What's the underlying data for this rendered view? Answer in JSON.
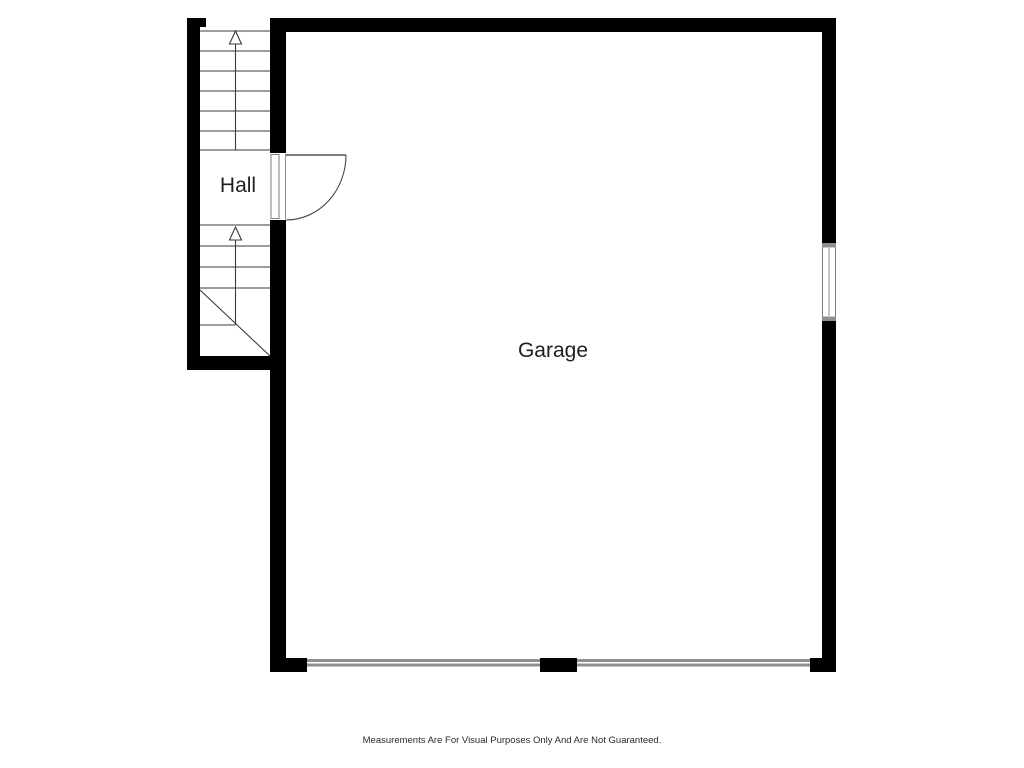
{
  "plan": {
    "labels": {
      "hall": "Hall",
      "garage": "Garage"
    },
    "stairs": {
      "upper_treads": 6,
      "lower_straight_treads": 3,
      "winder_treads": 3,
      "direction": "up",
      "arrow_count": 2
    },
    "openings": {
      "hinged_doors": 1,
      "windows": 1,
      "garage_doors": 2
    },
    "colors": {
      "wall": "#000000",
      "stair_line": "#3a3a3a",
      "frame_gray": "#8f8f8f",
      "label_text": "#1f1f1f",
      "background": "#ffffff"
    }
  },
  "footer": {
    "disclaimer": "Measurements Are For Visual Purposes Only And Are Not Guaranteed."
  }
}
